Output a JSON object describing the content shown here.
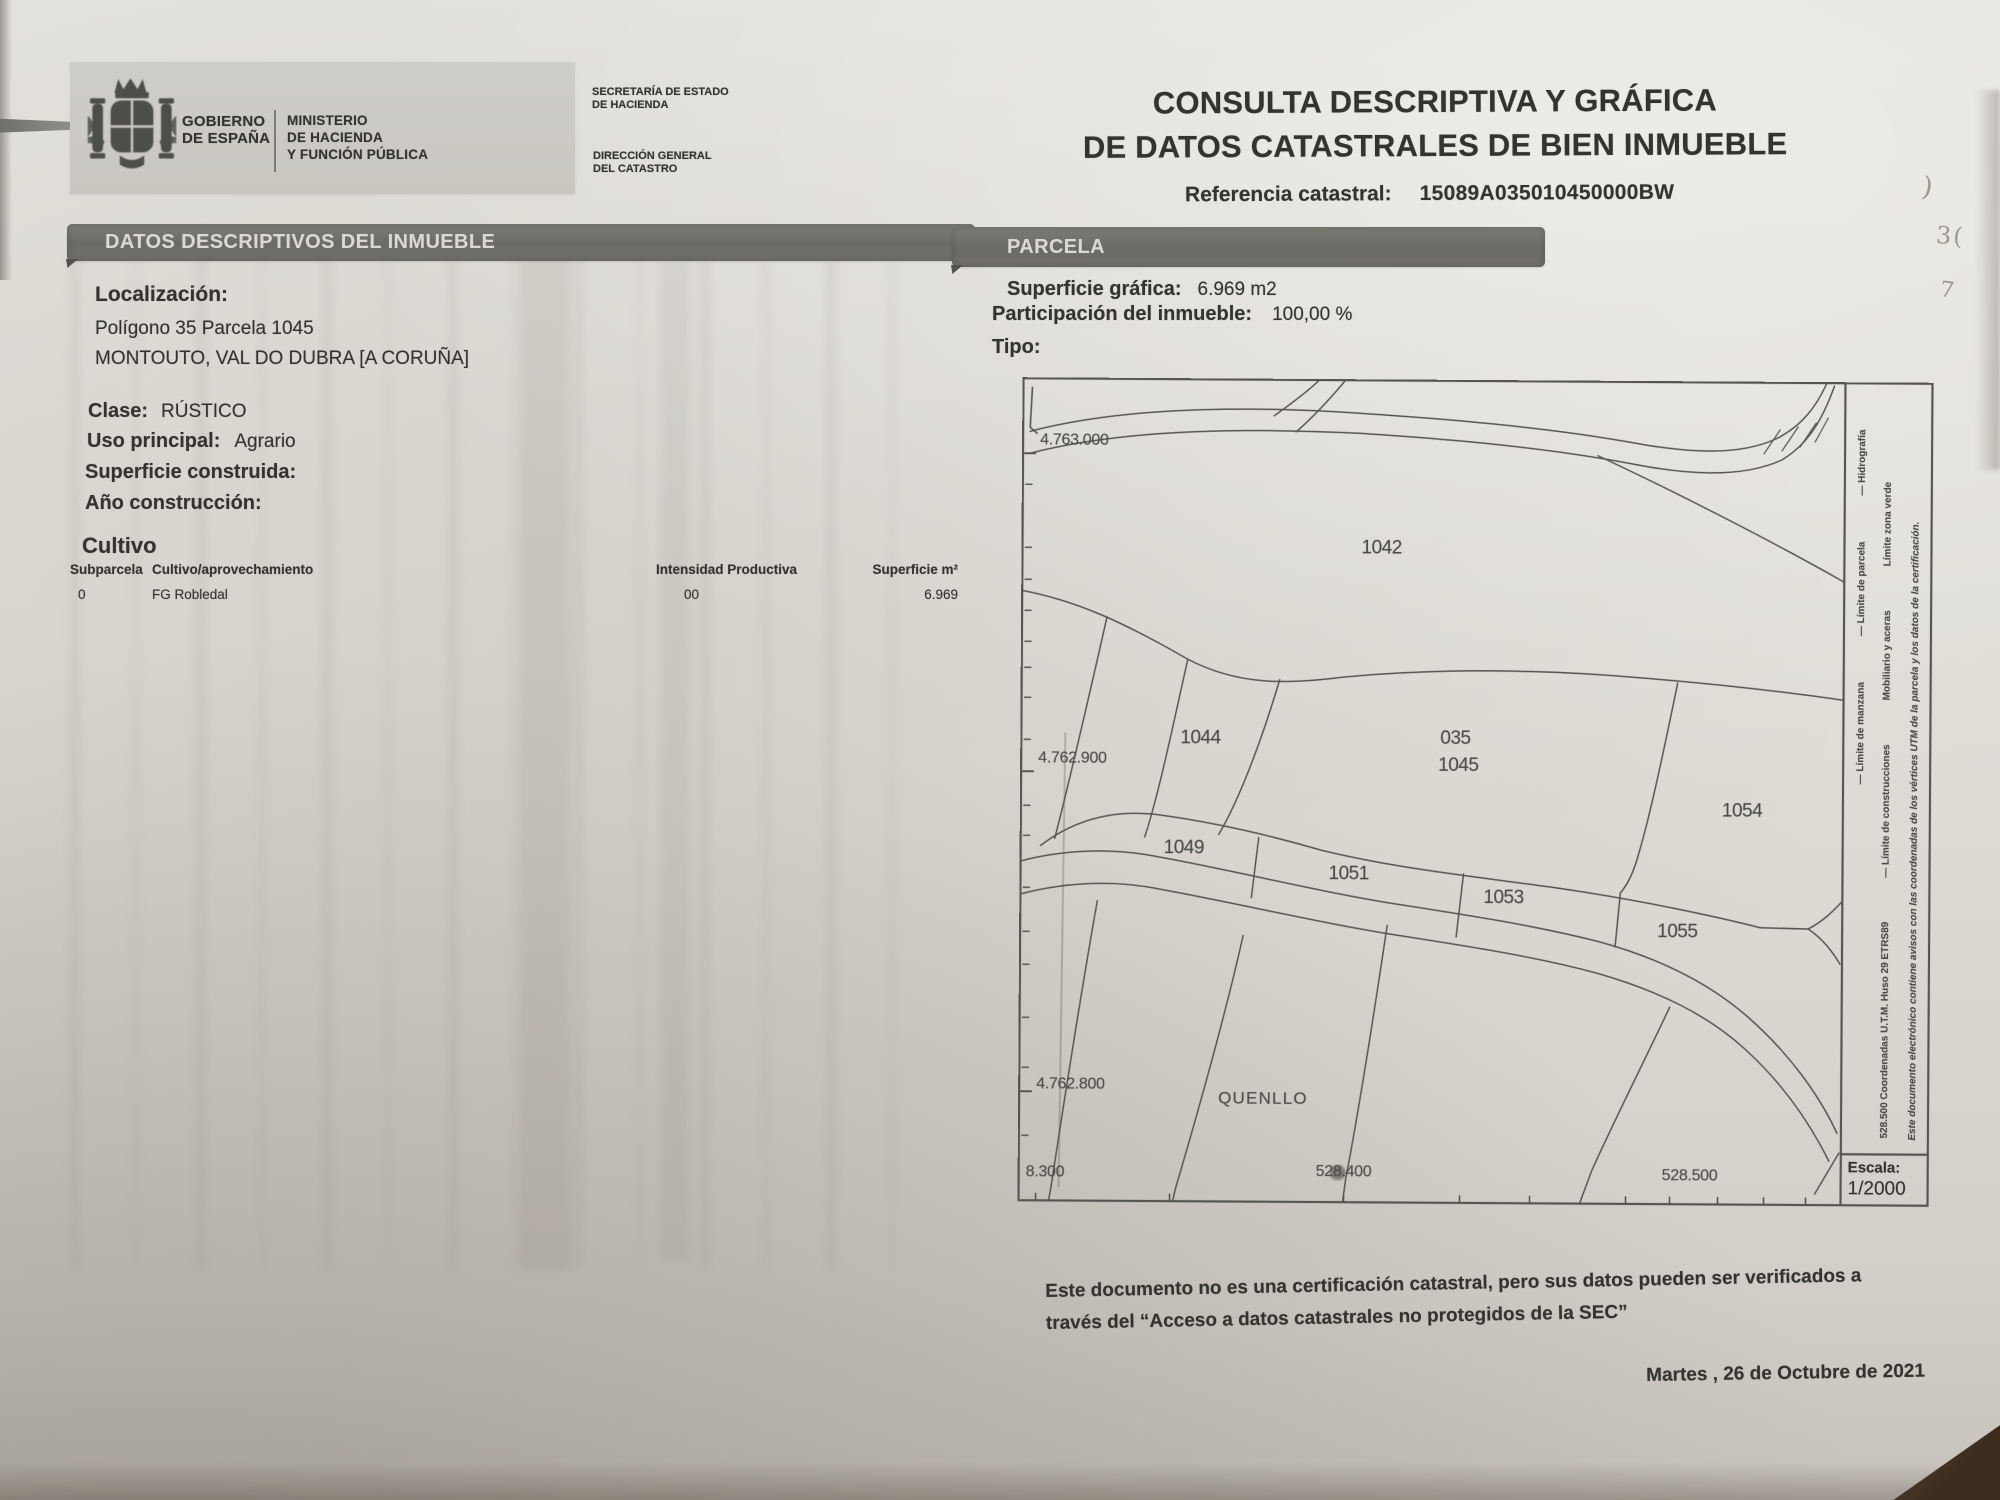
{
  "doc": {
    "logo": {
      "gobierno": "GOBIERNO\nDE ESPAÑA",
      "ministerio": "MINISTERIO\nDE HACIENDA\nY FUNCIÓN PÚBLICA",
      "secretaria": "SECRETARÍA DE ESTADO\nDE HACIENDA",
      "direccion": "DIRECCIÓN GENERAL\nDEL CATASTRO"
    },
    "title_line1": "CONSULTA DESCRIPTIVA Y GRÁFICA",
    "title_line2": "DE DATOS CATASTRALES DE BIEN INMUEBLE",
    "ref_label": "Referencia catastral:",
    "ref_value": "15089A035010450000BW"
  },
  "descriptivos": {
    "bar": "DATOS DESCRIPTIVOS DEL INMUEBLE",
    "localizacion_label": "Localización:",
    "localizacion_lines": [
      "Polígono 35 Parcela 1045",
      "MONTOUTO, VAL DO DUBRA [A CORUÑA]"
    ],
    "clase_label": "Clase:",
    "clase_value": "RÚSTICO",
    "uso_label": "Uso principal:",
    "uso_value": "Agrario",
    "sup_label": "Superficie construida:",
    "anio_label": "Año construcción:",
    "cultivo_title": "Cultivo",
    "tabla": {
      "headers": [
        "Subparcela",
        "Cultivo/aprovechamiento",
        "Intensidad Productiva",
        "Superficie m²"
      ],
      "rows": [
        [
          "0",
          "FG Robledal",
          "00",
          "6.969"
        ]
      ]
    }
  },
  "parcela": {
    "bar": "PARCELA",
    "sup_label": "Superficie gráfica:",
    "sup_value": "6.969 m2",
    "part_label": "Participación del inmueble:",
    "part_value": "100,00 %",
    "tipo_label": "Tipo:"
  },
  "map": {
    "y_axis": [
      "4.763.000",
      "4.762.900",
      "4.762.800"
    ],
    "x_axis": [
      "8.300",
      "528.400",
      "528.500"
    ],
    "parcels": [
      "1042",
      "1044",
      "035",
      "1045",
      "1054",
      "1049",
      "1051",
      "1053",
      "1055"
    ],
    "place": "QUENLLO",
    "legend_col1": [
      "— Límite de manzana",
      "— Límite de parcela",
      "— Hidrografía"
    ],
    "legend_col2": [
      "528.500 Coordenadas U.T.M. Huso 29 ETRS89",
      "— Límite de construcciones",
      "Mobiliario y aceras",
      "Límite zona verde"
    ],
    "legend_col3": "Este documento electrónico contiene avisos con las coordenadas de los vértices UTM de la parcela y los datos de la certificación.",
    "escala_label": "Escala:",
    "escala_value": "1/2000"
  },
  "footer": {
    "line1": "Este documento no es una certificación catastral, pero sus datos pueden ser verificados a",
    "line2": "través del “Acceso a datos catastrales no protegidos de la SEC”",
    "date": "Martes , 26 de Octubre de 2021"
  },
  "photo_marks": [
    ")",
    "3(",
    "7"
  ]
}
